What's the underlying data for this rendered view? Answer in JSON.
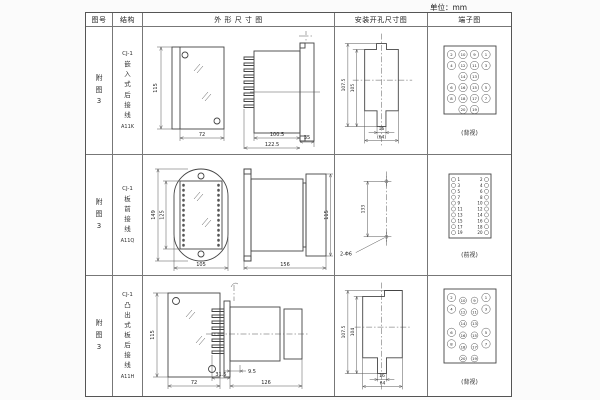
{
  "unit_label": "单位：mm",
  "headers": {
    "fig": "图号",
    "struct": "结构",
    "outline": "外 形 尺 寸 图",
    "install": "安装开孔尺寸图",
    "terminal": "端子图"
  },
  "rows": [
    {
      "fig_no": "附图3",
      "series": "CJ-1",
      "structure": "嵌入式后接线",
      "model": "A11K",
      "outline": {
        "front_h": "115",
        "front_w": "72",
        "body_len": "100.5",
        "total_len": "122.5",
        "flange": "35"
      },
      "install": {
        "cutout_h": "107.5",
        "cutout_h2": "105",
        "slot_w": "16",
        "cutout_w": "(64)"
      },
      "terminal": {
        "label": "(背视)",
        "layout": "grid20-rear",
        "grid": [
          [
            "2",
            "10",
            "9",
            "1"
          ],
          [
            "4",
            "12",
            "11",
            "3"
          ],
          [
            "",
            "14",
            "13",
            ""
          ],
          [
            "6",
            "16",
            "15",
            "5"
          ],
          [
            "8",
            "18",
            "17",
            "7"
          ],
          [
            "",
            "20",
            "19",
            ""
          ]
        ]
      }
    },
    {
      "fig_no": "附图3",
      "series": "CJ-1",
      "structure": "板前接线",
      "model": "A11Q",
      "outline": {
        "flange_h": "149",
        "window_h": "125",
        "flange_w": "105",
        "depth": "156",
        "rear_h": "115"
      },
      "install": {
        "hole_dist": "133",
        "holes": "2-Φ6"
      },
      "terminal": {
        "label": "(前视)",
        "layout": "cols-front",
        "pairs": [
          [
            "1",
            "2"
          ],
          [
            "3",
            "4"
          ],
          [
            "5",
            "6"
          ],
          [
            "7",
            "8"
          ],
          [
            "9",
            "10"
          ],
          [
            "11",
            "12"
          ],
          [
            "13",
            "14"
          ],
          [
            "15",
            "16"
          ],
          [
            "17",
            "18"
          ],
          [
            "19",
            "20"
          ]
        ]
      }
    },
    {
      "fig_no": "附图3",
      "series": "CJ-1",
      "structure": "凸出式板后接线",
      "model": "A11H",
      "outline": {
        "front_h": "115",
        "front_w": "72",
        "pin_depth": "9.5",
        "front_depth": "31.5",
        "body_len": "126"
      },
      "install": {
        "cutout_h": "107.5",
        "cutout_h2": "104",
        "slot_w": "16",
        "cutout_w": "64"
      },
      "terminal": {
        "label": "(背视)",
        "layout": "grid20-rear-staggered",
        "grid": [
          [
            "2",
            "10",
            "9",
            "1"
          ],
          [
            "4",
            "12",
            "11",
            "3"
          ],
          [
            "",
            "14",
            "13",
            ""
          ],
          [
            "6",
            "16",
            "15",
            "5"
          ],
          [
            "8",
            "18",
            "17",
            "7"
          ],
          [
            "",
            "20",
            "19",
            ""
          ]
        ]
      }
    }
  ]
}
